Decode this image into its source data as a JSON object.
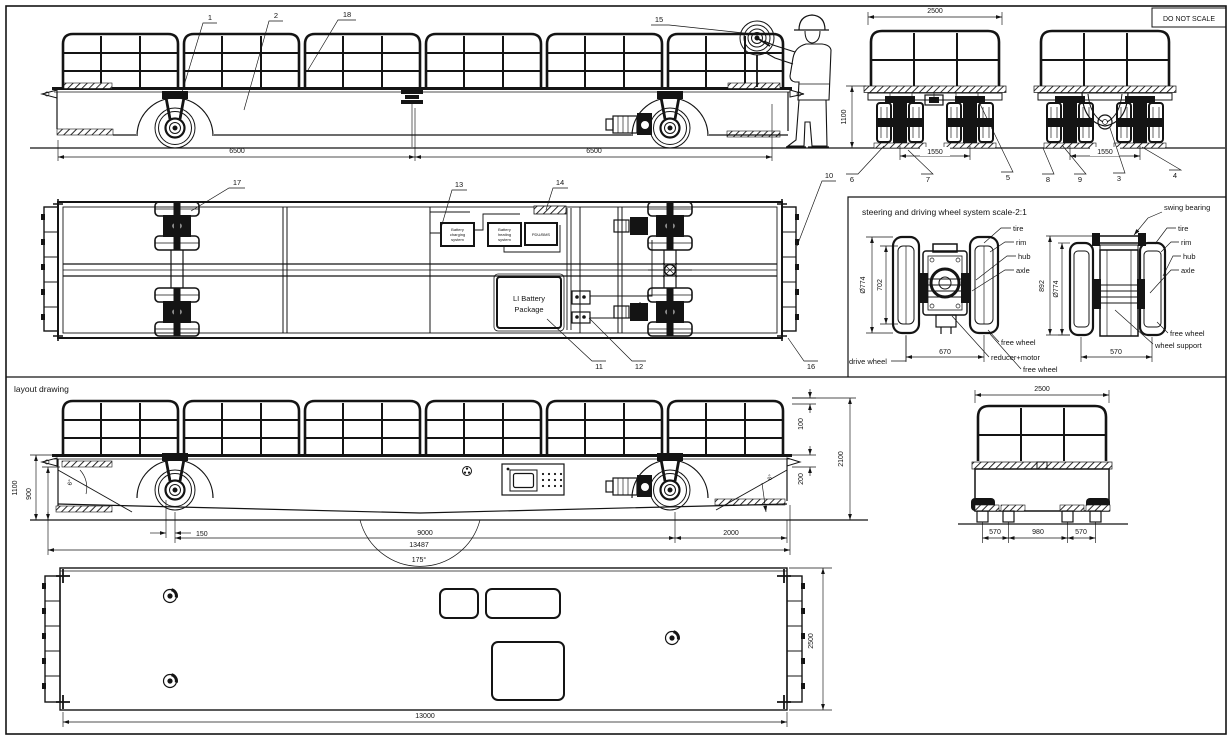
{
  "frame": {
    "do_not_scale": "DO NOT SCALE"
  },
  "top_side_view": {
    "callout_1": "1",
    "callout_2": "2",
    "callout_18": "18",
    "callout_15": "15",
    "dim_front_span": "6500",
    "dim_rear_span": "6500"
  },
  "top_end_views": {
    "dim_width": "2500",
    "dim_height": "1100",
    "dim_track_a": "1550",
    "dim_track_b": "1550",
    "callout_6": "6",
    "callout_7": "7",
    "callout_5": "5",
    "callout_8": "8",
    "callout_9": "9",
    "callout_3": "3",
    "callout_4": "4"
  },
  "plan_view": {
    "callout_17": "17",
    "callout_13": "13",
    "callout_14": "14",
    "callout_10": "10",
    "callout_16": "16",
    "callout_11": "11",
    "callout_12": "12",
    "battery_charging_lines": [
      "Battery",
      "charging",
      "system"
    ],
    "battery_heating_lines": [
      "Battery",
      "heating",
      "system"
    ],
    "pdu_bms": "PDU/BMS",
    "li_battery_lines": [
      "LI Battery",
      "Package"
    ]
  },
  "steering_detail": {
    "title": "steering and driving wheel system  scale-2:1",
    "left": {
      "dim_dia": "Ø774",
      "dim_rim": "702",
      "dim_track": "670",
      "label_tire": "tire",
      "label_rim": "rim",
      "label_hub": "hub",
      "label_axle": "axle",
      "label_free_wheel": "free wheel",
      "label_reducer_motor": "reducer+motor",
      "label_free_wheel_2": "free wheel",
      "label_drive_wheel": "drive wheel"
    },
    "right": {
      "dim_height": "892",
      "dim_dia": "Ø774",
      "dim_track": "570",
      "label_swing_bearing": "swing bearing",
      "label_tire": "tire",
      "label_rim": "rim",
      "label_hub": "hub",
      "label_axle": "axle",
      "label_free_wheel": "free wheel",
      "label_wheel_support": "wheel support"
    }
  },
  "layout_section": {
    "label": "layout drawing",
    "side": {
      "dim_deck_height": "1100",
      "dim_step_height": "900",
      "dim_front_angle": "6°",
      "dim_rear_angle": "6°",
      "dim_wheel_offset": "150",
      "dim_wheelbase": "9000",
      "dim_overall_length": "13487",
      "dim_bottom_angle": "175°",
      "dim_rear_overhang": "2000",
      "dim_rail_gap": "100",
      "dim_total_height": "2100",
      "dim_step_gap": "200"
    },
    "end": {
      "dim_width": "2500",
      "dim_left": "570",
      "dim_center": "980",
      "dim_right": "570"
    },
    "plan": {
      "dim_length": "13000",
      "dim_width": "2500"
    }
  }
}
